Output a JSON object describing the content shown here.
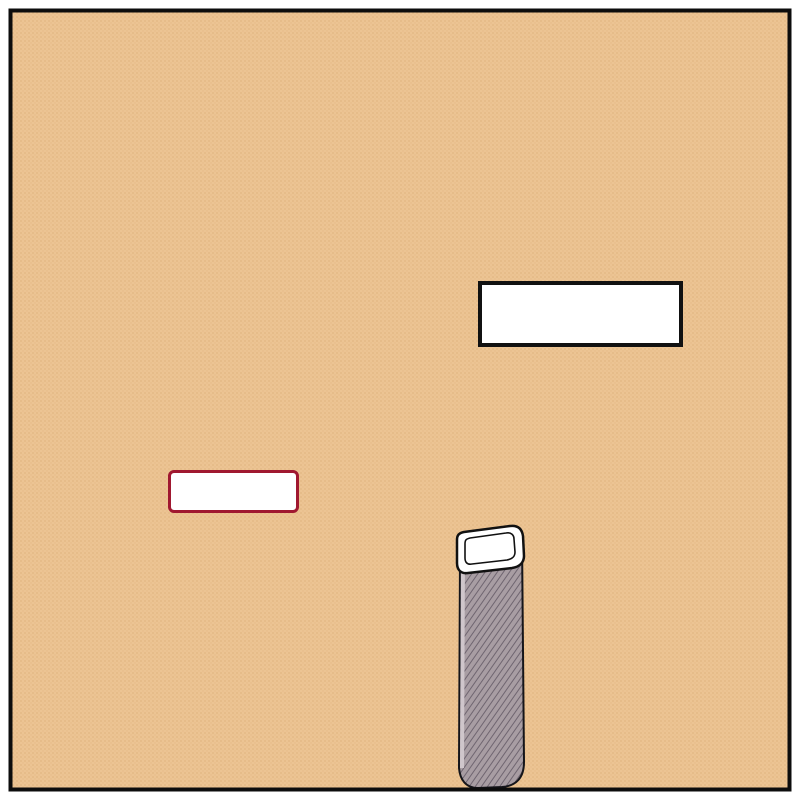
{
  "boxes": {
    "cabinet": {
      "label": "Cabinet Dentaire"
    },
    "paris15": {
      "label": "PARIS 15"
    }
  },
  "copyright": "© PLANFAX",
  "colors": {
    "land": "#ecc493",
    "land_dot": "#ddb07c",
    "street": "#ffffff",
    "major_casing": "#9e1a31",
    "minor_casing": "#1c1c1c",
    "arrow": "#c1242f",
    "metro_ring": "#79c4bc",
    "metro_dark": "#17756b",
    "metro_inner": "#f4fbfa",
    "marker_fill": "#bccfd6",
    "marker_edge": "#8fa7ae",
    "hospital_blue": "#567fb8",
    "hospital_edge": "#9fb6da",
    "parking_blue": "#3f5f8f",
    "parking_edge": "#8aa3c8",
    "label_ink": "#1d1d1d",
    "pointer_ink": "#111111"
  },
  "map": {
    "streets": {
      "major": [
        {
          "name": "boulevard-du-montparnasse",
          "pts": [
            [
              88,
              70
            ],
            [
              335,
              328
            ],
            [
              470,
              407
            ],
            [
              662,
              494
            ]
          ],
          "cw": 28,
          "fw": 20
        },
        {
          "name": "rue-de-rennes",
          "pts": [
            [
              655,
              492
            ],
            [
              808,
              328
            ]
          ],
          "cw": 26,
          "fw": 18
        },
        {
          "name": "place-east-exit",
          "pts": [
            [
              660,
              497
            ],
            [
              808,
              527
            ]
          ],
          "cw": 30,
          "fw": 22
        },
        {
          "name": "avenue-du-maine",
          "pts": [
            [
              335,
              328
            ],
            [
              366,
              452
            ],
            [
              400,
              592
            ],
            [
              424,
              682
            ],
            [
              452,
              748
            ],
            [
              468,
              808
            ]
          ],
          "cw": 24,
          "fw": 16
        },
        {
          "name": "bd-de-vaugirard",
          "pts": [
            [
              178,
              808
            ],
            [
              430,
              700
            ],
            [
              632,
              654
            ]
          ],
          "cw": 24,
          "fw": 16
        },
        {
          "name": "rue-du-depart",
          "pts": [
            [
              665,
              498
            ],
            [
              654,
              622
            ],
            [
              548,
              794
            ],
            [
              542,
              808
            ]
          ],
          "cw": 24,
          "fw": 16
        },
        {
          "name": "sw-corner-street",
          "pts": [
            [
              -8,
              735
            ],
            [
              68,
              808
            ]
          ],
          "cw": 22,
          "fw": 15
        },
        {
          "name": "se-corner-street",
          "pts": [
            [
              808,
              705
            ],
            [
              758,
              808
            ]
          ],
          "cw": 20,
          "fw": 14
        },
        {
          "name": "rue-de-l-arrivee",
          "pts": [
            [
              450,
              474
            ],
            [
              540,
              562
            ],
            [
              592,
              650
            ]
          ],
          "cw": 20,
          "fw": 13
        }
      ],
      "minor": [
        {
          "name": "duroc-north",
          "pts": [
            [
              26,
              -8
            ],
            [
              92,
              76
            ]
          ]
        },
        {
          "name": "duroc-west",
          "pts": [
            [
              92,
              76
            ],
            [
              -8,
              172
            ]
          ]
        },
        {
          "name": "duroc-northwest",
          "pts": [
            [
              -8,
              98
            ],
            [
              92,
              76
            ]
          ]
        },
        {
          "name": "rue-mayet",
          "pts": [
            [
              176,
              0
            ],
            [
              322,
              250
            ]
          ]
        },
        {
          "name": "rue-du-cherche-midi",
          "pts": [
            [
              150,
              340
            ],
            [
              585,
              6
            ]
          ]
        },
        {
          "name": "rue-de-vaugirard",
          "pts": [
            [
              -8,
              452
            ],
            [
              808,
              139
            ]
          ]
        },
        {
          "name": "ne-connector",
          "pts": [
            [
              600,
              2
            ],
            [
              678,
              186
            ]
          ]
        },
        {
          "name": "ne-corner-street",
          "pts": [
            [
              674,
              -8
            ],
            [
              808,
              74
            ]
          ]
        },
        {
          "name": "east-connector",
          "pts": [
            [
              700,
              181
            ],
            [
              748,
              236
            ],
            [
              808,
              240
            ]
          ]
        },
        {
          "name": "hopital-necker-drive",
          "pts": [
            [
              215,
              204
            ],
            [
              112,
              232
            ],
            [
              124,
              276
            ]
          ],
          "cw": 14,
          "fw": 9
        },
        {
          "name": "rue-falguiere",
          "pts": [
            [
              168,
              390
            ],
            [
              52,
              590
            ]
          ]
        },
        {
          "name": "west-exit",
          "pts": [
            [
              52,
              590
            ],
            [
              -8,
              572
            ]
          ]
        },
        {
          "name": "rue-antoine-bourdelle",
          "pts": [
            [
              52,
              590
            ],
            [
              225,
              633
            ],
            [
              396,
              576
            ]
          ]
        },
        {
          "name": "rue-armand-moisant",
          "pts": [
            [
              58,
              606
            ],
            [
              190,
              808
            ]
          ]
        },
        {
          "name": "sw-parallel-street",
          "pts": [
            [
              -8,
              652
            ],
            [
              100,
              808
            ]
          ]
        },
        {
          "name": "rue-du-montparnasse-stub",
          "pts": [
            [
              394,
              372
            ],
            [
              452,
              478
            ]
          ],
          "cw": 15,
          "fw": 10
        },
        {
          "name": "paris15-stub",
          "pts": [
            [
              196,
              514
            ],
            [
              196,
              537
            ],
            [
              214,
              537
            ]
          ],
          "cw": 11,
          "fw": 6
        },
        {
          "name": "falguiere-stub",
          "pts": [
            [
              137,
              563
            ],
            [
              196,
              553
            ]
          ],
          "cw": 11,
          "fw": 6
        },
        {
          "name": "gare-south-street",
          "pts": [
            [
              740,
              598
            ],
            [
              705,
              710
            ],
            [
              678,
              808
            ]
          ]
        },
        {
          "name": "gare-south-branch",
          "pts": [
            [
              705,
              710
            ],
            [
              748,
              808
            ]
          ]
        },
        {
          "name": "rue-littre",
          "pts": [
            [
              648,
              197
            ],
            [
              726,
              390
            ]
          ],
          "cw": 16,
          "fw": 10
        }
      ]
    },
    "plazas": [
      {
        "cx": 662,
        "cy": 497,
        "rx": 44,
        "ry": 32,
        "rot": -25
      },
      {
        "cx": 335,
        "cy": 328,
        "rx": 14,
        "ry": 14,
        "rot": 0
      },
      {
        "cx": 92,
        "cy": 76,
        "rx": 12,
        "ry": 12,
        "rot": 0
      },
      {
        "cx": 592,
        "cy": 648,
        "rx": 16,
        "ry": 13,
        "rot": -20
      },
      {
        "cx": 428,
        "cy": 692,
        "rx": 14,
        "ry": 12,
        "rot": -20
      }
    ],
    "arrows": [
      [
        243,
        122,
        60
      ],
      [
        361,
        194,
        141
      ],
      [
        459,
        107,
        141
      ],
      [
        174,
        381,
        159
      ],
      [
        27,
        457,
        159
      ],
      [
        590,
        227,
        159
      ],
      [
        641,
        99,
        118
      ],
      [
        757,
        241,
        2
      ],
      [
        80,
        535,
        -60
      ],
      [
        66,
        593,
        194
      ],
      [
        223,
        622,
        194
      ],
      [
        388,
        668,
        -105
      ],
      [
        418,
        678,
        -105
      ],
      [
        731,
        653,
        107
      ],
      [
        409,
        414,
        118
      ],
      [
        561,
        509,
        -135
      ]
    ],
    "street_labels": [
      {
        "t": "Boulevard",
        "x": 122,
        "y": 152,
        "r": 46,
        "s": 17
      },
      {
        "t": "Rue",
        "x": 201,
        "y": 64,
        "r": 57,
        "s": 14
      },
      {
        "t": "Mayet",
        "x": 257,
        "y": 133,
        "r": 57,
        "s": 14
      },
      {
        "t": "Rue",
        "x": 298,
        "y": 240,
        "r": -38,
        "s": 14
      },
      {
        "t": "du",
        "x": 340,
        "y": 210,
        "r": -38,
        "s": 14
      },
      {
        "t": "Cherche",
        "x": 413,
        "y": 146,
        "r": -38,
        "s": 14
      },
      {
        "t": "Midi",
        "x": 503,
        "y": 73,
        "r": -38,
        "s": 14
      },
      {
        "t": "Rue du",
        "x": 181,
        "y": 314,
        "r": -48,
        "s": 13
      },
      {
        "t": "Cherche Midi",
        "x": 228,
        "y": 257,
        "r": -55,
        "s": 13
      },
      {
        "t": "Rue de",
        "x": 80,
        "y": 429,
        "r": -17,
        "s": 14
      },
      {
        "t": "Rue",
        "x": 451,
        "y": 290,
        "r": -21,
        "s": 14.5
      },
      {
        "t": "de",
        "x": 532,
        "y": 254,
        "r": -21,
        "s": 14.5
      },
      {
        "t": "Vaugirard",
        "x": 658,
        "y": 198,
        "r": -21,
        "s": 14.5
      },
      {
        "t": "Falguière",
        "x": 102,
        "y": 494,
        "r": -56,
        "s": 14
      },
      {
        "t": "Rue",
        "x": 31,
        "y": 607,
        "r": -62,
        "s": 14
      },
      {
        "t": "Rue Antoine",
        "x": 150,
        "y": 612,
        "r": 12,
        "s": 14
      },
      {
        "t": "Bourdelle",
        "x": 301,
        "y": 597,
        "r": -17,
        "s": 14.5
      },
      {
        "t": "R. Armand Moisant",
        "x": 123,
        "y": 704,
        "r": 56,
        "s": 13.5
      },
      {
        "t": "Avenue",
        "x": 344,
        "y": 414,
        "r": 74,
        "s": 15
      },
      {
        "t": "du",
        "x": 371,
        "y": 519,
        "r": 76,
        "s": 15
      },
      {
        "t": "Maine",
        "x": 397,
        "y": 624,
        "r": 78,
        "s": 15
      },
      {
        "t": "Bd de Vaugirard",
        "x": 346,
        "y": 747,
        "r": -21,
        "s": 16
      },
      {
        "t": "Départ",
        "x": 670,
        "y": 626,
        "r": -51,
        "s": 15
      },
      {
        "t": "Rue du",
        "x": 564,
        "y": 746,
        "r": -58,
        "s": 14
      },
      {
        "t": "R. de Rennes",
        "x": 744,
        "y": 401,
        "r": -54,
        "s": 14
      },
      {
        "t": "Rue",
        "x": 674,
        "y": 264,
        "r": 62,
        "s": 13
      },
      {
        "t": "Littré",
        "x": 713,
        "y": 333,
        "r": 62,
        "s": 13
      },
      {
        "t": "Montparnasse",
        "x": 416,
        "y": 368,
        "r": 25,
        "s": 15,
        "ls": 2
      }
    ],
    "place_labels": [
      {
        "name": "duroc",
        "lines": [
          "Duroc"
        ],
        "x": 86,
        "y": 84,
        "lh": 0,
        "s": 18
      },
      {
        "name": "hopital-necker",
        "lines": [
          "Hôpital",
          "Necker"
        ],
        "x": 62,
        "y": 258,
        "lh": 23,
        "s": 18
      },
      {
        "name": "falguiere",
        "lines": [
          "Falguière"
        ],
        "x": 95,
        "y": 356,
        "lh": 0,
        "s": 18
      },
      {
        "name": "place-du-18-juin-1940",
        "lines": [
          "Place du",
          "18 Juin 1940"
        ],
        "x": 647,
        "y": 392,
        "lh": 21,
        "s": 16.5
      },
      {
        "name": "montparnasse-bienvenue-est",
        "lines": [
          "Montparnasse",
          "Bienvenue"
        ],
        "x": 684,
        "y": 545,
        "lh": 18,
        "s": 15
      },
      {
        "name": "montparnasse-bienvenue-sud",
        "lines": [
          "Montparnasse",
          "Bienvenue"
        ],
        "x": 270,
        "y": 692,
        "lh": 20,
        "s": 15.5
      },
      {
        "name": "place-bienvenue",
        "lines": [
          "Place",
          "Bienvenüe"
        ],
        "x": 296,
        "y": 646,
        "lh": 20,
        "s": 15.5
      },
      {
        "name": "galeries-lafayette",
        "lines": [
          "Galeries",
          "Lafayette"
        ],
        "x": 576,
        "y": 613,
        "lh": 20,
        "s": 14.5,
        "anchor": "start"
      },
      {
        "name": "tour-montparnasse",
        "lines": [
          "Tour",
          "Montparnasse"
        ],
        "x": 538,
        "y": 677,
        "lh": 34,
        "s": 27,
        "anchor": "start"
      }
    ],
    "metro_stations": [
      {
        "name": "duroc",
        "x": 62,
        "y": 47,
        "r": 17
      },
      {
        "name": "falguiere",
        "x": 140,
        "y": 381,
        "r": 16
      },
      {
        "name": "place-du-18-juin-1940",
        "x": 632,
        "y": 434,
        "r": 16
      },
      {
        "name": "montparnasse-bienvenue-sud",
        "x": 358,
        "y": 697,
        "r": 17
      },
      {
        "name": "montparnasse-bienvenue-est",
        "x": 746,
        "y": 594,
        "r": 15
      }
    ],
    "hospital_icon": {
      "letter": "H",
      "x": 43,
      "y": 295,
      "s": 29
    },
    "parking_icon": {
      "letter": "P",
      "x": 540,
      "y": 588,
      "s": 28
    },
    "marker": {
      "x": 371,
      "y": 400,
      "r": 16
    },
    "callout_line": [
      374,
      396,
      505,
      331
    ],
    "pointers": [
      {
        "line": [
          657,
          420,
          671,
          483
        ],
        "dot": [
          671,
          483
        ]
      },
      {
        "line": [
          363,
          655,
          387,
          654
        ],
        "dot": [
          388,
          654
        ]
      }
    ],
    "metro_letter": "M"
  }
}
